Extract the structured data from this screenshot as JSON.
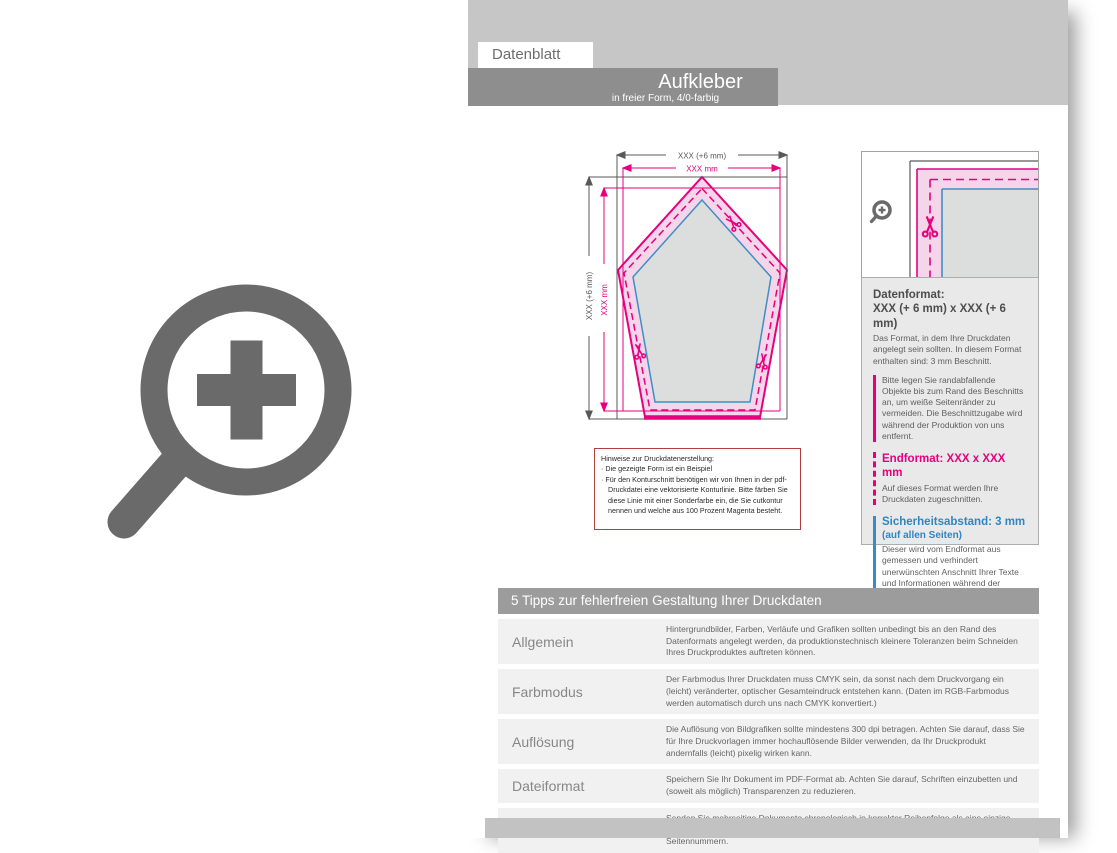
{
  "header": {
    "tab": "Datenblatt",
    "title": "Aufkleber",
    "subtitle": "in freier Form, 4/0-farbig"
  },
  "diagram": {
    "dim_width_total": "XXX (+6 mm)",
    "dim_width_final": "XXX mm",
    "dim_height_total": "XXX (+6 mm)",
    "dim_height_final": "XXX mm",
    "note_title": "Hinweise zur Druckdatenerstellung:",
    "note_item_1": "Die gezeigte Form ist ein Beispiel",
    "note_item_2": "Für den Konturschnitt benötigen wir von Ihnen in der pdf-Druckdatei eine vektorisierte Konturlinie. Bitte färben Sie diese Linie mit einer Sonderfarbe ein, die Sie cutkontur nennen und welche aus 100 Prozent Magenta besteht."
  },
  "info_panel": {
    "datenformat_title": "Datenformat:",
    "datenformat_value": "XXX (+ 6 mm) x XXX (+ 6 mm)",
    "datenformat_body": "Das Format, in dem Ihre Druckdaten angelegt sein sollten. In diesem Format enthalten sind: 3 mm Beschnitt.",
    "bleed_note": "Bitte legen Sie randabfallende Objekte bis zum Rand des Beschnitts an, um weiße Seitenränder zu vermeiden. Die Beschnittzugabe wird während der Produktion von uns entfernt.",
    "endformat_title": "Endformat: XXX x XXX mm",
    "endformat_body": "Auf dieses Format werden Ihre Druckdaten zugeschnitten.",
    "sicherheitsabstand_title": "Sicherheitsabstand: 3 mm",
    "sicherheitsabstand_sub": "(auf allen Seiten)",
    "sicherheitsabstand_body": "Dieser wird vom Endformat aus gemessen und verhindert unerwünschten Anschnitt Ihrer Texte und Informationen während der Produktion."
  },
  "tips": {
    "header": "5 Tipps zur fehlerfreien Gestaltung Ihrer Druckdaten",
    "rows": [
      {
        "label": "Allgemein",
        "text": "Hintergrundbilder, Farben, Verläufe und Grafiken sollten unbedingt bis an den Rand des Datenformats angelegt werden, da produktionstechnisch kleinere Toleranzen beim Schneiden Ihres Druckproduktes auftreten können."
      },
      {
        "label": "Farbmodus",
        "text": "Der Farbmodus Ihrer Druckdaten muss CMYK sein, da sonst nach dem Druckvorgang ein (leicht) veränderter, optischer Gesamteindruck entstehen kann. (Daten im RGB-Farbmodus werden automatisch durch uns nach CMYK konvertiert.)"
      },
      {
        "label": "Auflösung",
        "text": "Die Auflösung von Bildgrafiken sollte mindestens 300 dpi betragen. Achten Sie darauf, dass Sie für Ihre Druckvorlagen immer hochauflösende Bilder verwenden, da Ihr Druckprodukt andernfalls (leicht) pixelig wirken kann."
      },
      {
        "label": "Dateiformat",
        "text": "Speichern Sie Ihr Dokument im PDF-Format ab. Achten Sie darauf, Schriften einzubetten und (soweit als möglich) Transparenzen zu reduzieren."
      },
      {
        "label": "Seiten(-reihenfolge)",
        "text": "Senden Sie mehrseitige Dokumente chronologisch in korrekter Reihenfolge als eine einzige PDF-Datei oder benennen Sie Einzeldokumente entsprechend mit fortlaufenden Seitennummern."
      }
    ]
  },
  "icons": {
    "large": "zoom-plus-icon",
    "inset": "magnifier-plus-icon",
    "cut": "scissors-icon"
  },
  "colors": {
    "magenta": "#e6007e",
    "blue": "#3f8ec6",
    "dark_line": "#58595b",
    "band_gray": "#c6c6c6",
    "title_gray": "#8e8e8e",
    "table_header_gray": "#9c9c9c"
  }
}
